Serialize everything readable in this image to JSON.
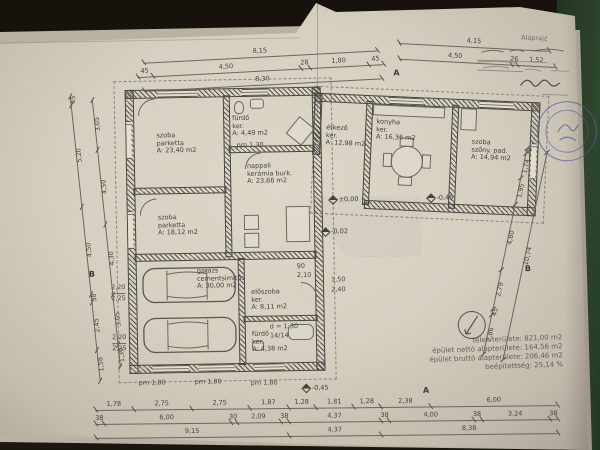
{
  "drawing": {
    "form_title": "Alaprajz",
    "handwritten_note": "ifj. ... aláírás",
    "stamp": "kör alakú pecsét"
  },
  "rooms": [
    {
      "name": "szoba",
      "floor": "parketta",
      "area": "A: 23,40 m2"
    },
    {
      "name": "szoba",
      "floor": "parketta",
      "area": "A: 18,12 m2"
    },
    {
      "name": "nappali",
      "floor": "kerámia burk.",
      "area": "A: 23,66 m2"
    },
    {
      "name": "fürdő",
      "floor": "ker.",
      "area": "A: 4,49 m2"
    },
    {
      "name": "garázs",
      "floor": "cementsimítás",
      "area": "A: 30,00 m2"
    },
    {
      "name": "előszoba",
      "floor": "ker.",
      "area": "A: 8,11 m2"
    },
    {
      "name": "fürdő",
      "floor": "ker.",
      "area": "A: 4,38 m2"
    },
    {
      "name": "étkező",
      "floor": "ker.",
      "area": "A: 12,98 m2"
    },
    {
      "name": "konyha",
      "floor": "ker.",
      "area": "A: 16,36 m2"
    },
    {
      "name": "szoba",
      "floor": "szőny. pad.",
      "area": "A: 14,94 m2"
    }
  ],
  "levels": {
    "zero": "±0,00",
    "minus02": "-0,02",
    "minus45a": "-0,45",
    "minus45b": "-0,45"
  },
  "pm": {
    "pm130": "pm 1,30",
    "pm180a": "pm 1,80",
    "pm180b": "pm 1,80",
    "pm180c": "pm 1,80"
  },
  "ramp": {
    "slope": "d = 1:30",
    "steps": "14/14"
  },
  "wall_notes": {
    "n90": "90",
    "n210": "2,10",
    "n150": "1,50",
    "n240": "2,40",
    "g220a": "2,20",
    "g225a": "2,25",
    "g220b": "2,20",
    "g225b": "2,25"
  },
  "markers": {
    "a_top": "A",
    "a_bottom": "A",
    "b_left": "B",
    "b_right": "B"
  },
  "dims": {
    "top1": [
      "8,15"
    ],
    "top2": [
      "45",
      "4,50",
      "28",
      "1,80",
      "45"
    ],
    "top3": [
      "8,30"
    ],
    "topr1": [
      "4,15"
    ],
    "topr2": [
      "4,50",
      "26",
      "1,52"
    ],
    "bottom1": [
      "1,78",
      "2,75",
      "2,75",
      "1,87",
      "1,28",
      "1,81",
      "1,28",
      "2,38",
      "6,00"
    ],
    "bottom2": [
      "38",
      "6,00",
      "30",
      "2,09",
      "38",
      "4,37",
      "38",
      "4,00",
      "38",
      "3,24",
      "38"
    ],
    "bottom3": [
      "9,15",
      "4,37",
      "8,38"
    ],
    "left_outer": [
      "45",
      "5,20",
      "4,50",
      "38",
      "2,45",
      "1,58"
    ],
    "left_inner": [
      "3,05",
      "4,50",
      "4,30",
      "3,05",
      "1,30"
    ],
    "right_side": [
      "38",
      "1,74",
      "1,95",
      "4,80",
      "2,79",
      "45",
      "2,86"
    ],
    "right_total": [
      "10,74"
    ]
  },
  "info": {
    "lines": [
      {
        "label": "telek területe:",
        "value": "821,00 m2"
      },
      {
        "label": "épület nettó alapterülete:",
        "value": "164,56 m2"
      },
      {
        "label": "épület bruttó alapterülete:",
        "value": "206,46 m2"
      },
      {
        "label": "beépítettség:",
        "value": "25,14 %"
      }
    ]
  }
}
